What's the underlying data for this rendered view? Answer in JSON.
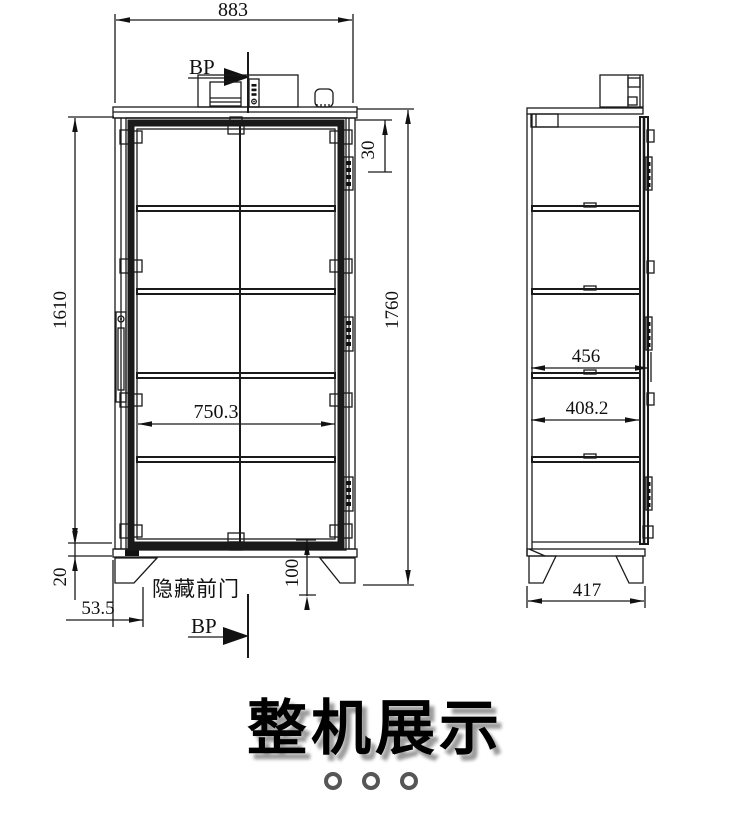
{
  "drawing": {
    "front": {
      "dim_width": "883",
      "dim_h_left": "1610",
      "dim_h_right": "1760",
      "dim_top": "30",
      "dim_inner_w": "750.3",
      "dim_bottom": "20",
      "dim_foot_x": "53.5",
      "dim_foot_h": "100",
      "label_bp": "BP",
      "label_door": "隐藏前门"
    },
    "side": {
      "dim_outer": "456",
      "dim_inner": "408.2",
      "dim_feet": "417"
    }
  },
  "title": "整机展示",
  "pager": {
    "dot_count": 3
  },
  "colors": {
    "line": "#1a1a1a",
    "title_shadow": "#9b9b9b",
    "dot_ring": "#565656"
  }
}
